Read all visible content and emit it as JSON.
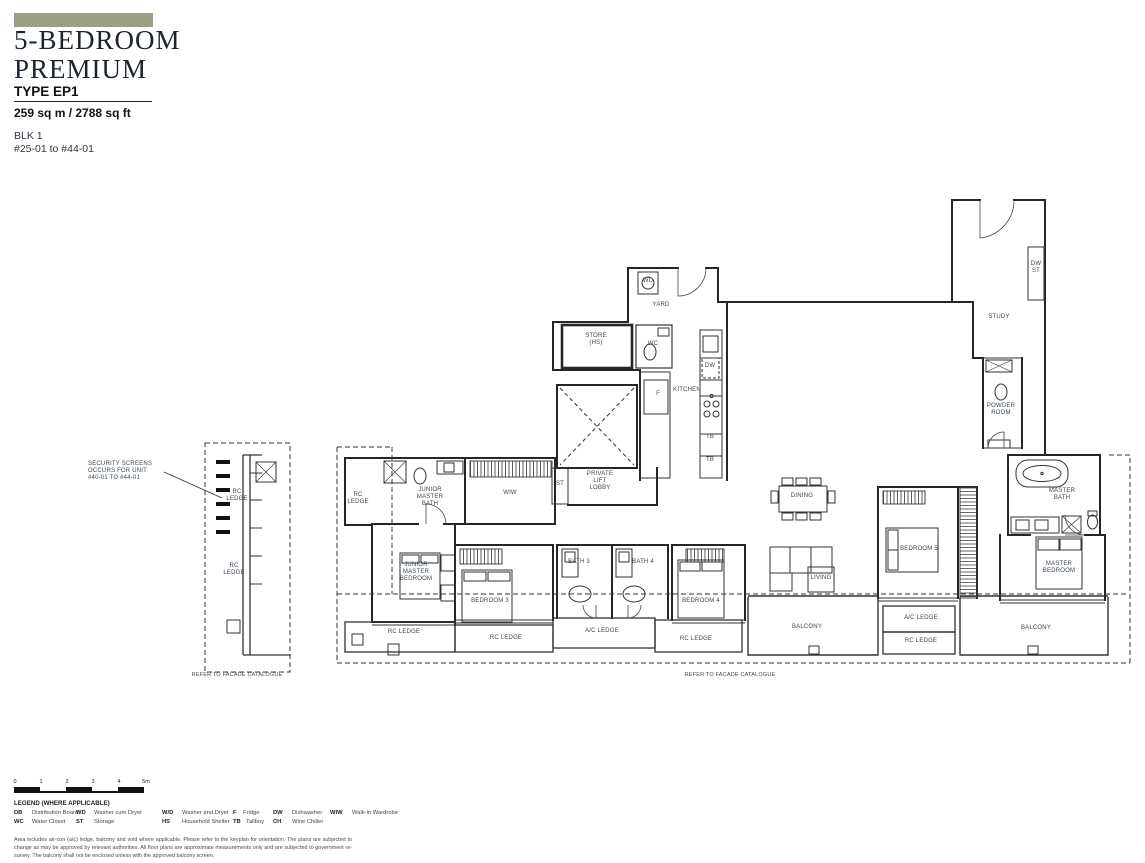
{
  "colors": {
    "accent_bar": "#9c9e86",
    "plan_text": "#3a4754",
    "wall": "#262626"
  },
  "header": {
    "title_line1": "5-BEDROOM",
    "title_line2": "PREMIUM",
    "type_label": "TYPE EP1",
    "area": "259 sq m / 2788 sq ft",
    "block": "BLK 1",
    "units": "#25-01 to #44-01"
  },
  "plan": {
    "labels": {
      "security_note": "SECURITY SCREENS\nOCCURS FOR UNIT\n#40-01 TO #44-01",
      "rc_ledge_strip_top": "RC\nLEDGE",
      "rc_ledge_strip_bottom": "RC\nLEDGE",
      "refer_facade_left": "REFER TO FACADE CATALOGUE",
      "refer_facade_main": "REFER TO FACADE CATALOGUE",
      "wd": "WD",
      "yard": "YARD",
      "store": "STORE\n(HS)",
      "wc": "WC",
      "dw": "DW",
      "kitchen": "KITCHEN",
      "fridge": "F",
      "tb_upper": "TB",
      "tb_lower": "TB",
      "dw_st": "DW\nST",
      "study": "STUDY",
      "powder_room": "POWDER\nROOM",
      "st": "ST",
      "private_lift_lobby": "PRIVATE\nLIFT\nLOBBY",
      "rc_ledge_left": "RC\nLEDGE",
      "junior_master_bath": "JUNIOR\nMASTER\nBATH",
      "wiw": "WIW",
      "junior_master_bedroom": "JUNIOR\nMASTER\nBEDROOM",
      "bedroom3": "BEDROOM 3",
      "bath3": "BATH 3",
      "bath4": "BATH 4",
      "bedroom4": "BEDROOM 4",
      "dining": "DINING",
      "living": "LIVING",
      "bedroom5": "BEDROOM 5",
      "master_bath": "MASTER\nBATH",
      "master_bedroom": "MASTER\nBEDROOM",
      "rc_ledge_bottom_left": "RC LEDGE",
      "rc_ledge_bedroom3": "RC LEDGE",
      "ac_ledge_baths": "A/C LEDGE",
      "rc_ledge_bedroom4": "RC LEDGE",
      "balcony_left": "BALCONY",
      "ac_ledge_master": "A/C LEDGE",
      "rc_ledge_master": "RC LEDGE",
      "balcony_right": "BALCONY"
    }
  },
  "scale_bar": {
    "ticks": [
      "0",
      "1",
      "2",
      "3",
      "4",
      "5m"
    ]
  },
  "legend": {
    "title": "LEGEND (WHERE APPLICABLE)",
    "items": [
      {
        "abbr": "DB",
        "label": "Distribution Board"
      },
      {
        "abbr": "WD",
        "label": "Washer cum Dryer"
      },
      {
        "abbr": "W/D",
        "label": "Washer and Dryer"
      },
      {
        "abbr": "F",
        "label": "Fridge"
      },
      {
        "abbr": "DW",
        "label": "Dishwasher"
      },
      {
        "abbr": "WIW",
        "label": "Walk-in Wardrobe"
      },
      {
        "abbr": "WC",
        "label": "Water Closet"
      },
      {
        "abbr": "ST",
        "label": "Storage"
      },
      {
        "abbr": "HS",
        "label": "Household Shelter"
      },
      {
        "abbr": "TB",
        "label": "Tallboy"
      },
      {
        "abbr": "CH",
        "label": "Wine Chiller"
      }
    ]
  },
  "disclaimer": "Area includes air-con (a/c) ledge, balcony and void where applicable. Please refer to the keyplan for orientation. The plans are subjected to change as may be approved by relevant authorities. All floor plans are approximate measurements only and are subjected to government re-survey. The balcony shall not be enclosed unless with the approved balcony screen."
}
